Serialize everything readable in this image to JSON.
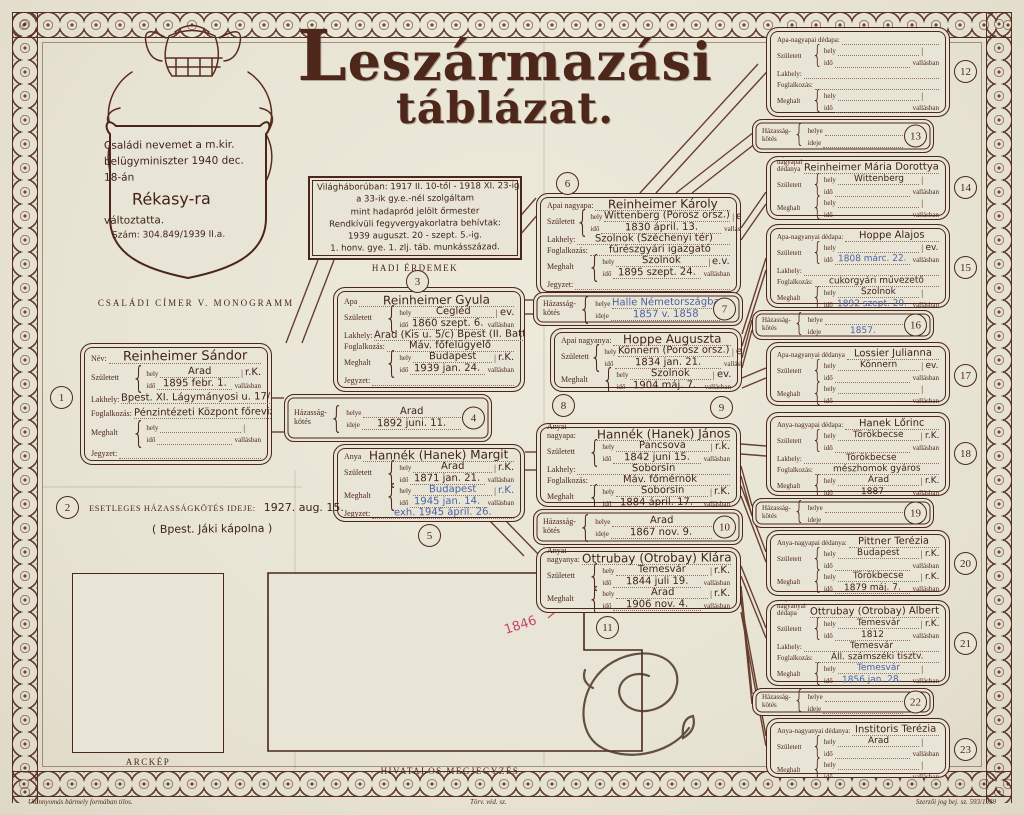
{
  "title": {
    "line1": "Leszármazási",
    "line2": "táblázat."
  },
  "fl": {
    "szuletett": "Született",
    "meghalt": "Meghalt",
    "hely": "hely",
    "ido": "idő",
    "vallasban": "vallásban",
    "lakhely": "Lakhely:",
    "foglalkozas": "Foglalkozás:",
    "jegyzet": "Jegyzet:",
    "hazassag": "Házasság-",
    "kotes": "kötés",
    "helye": "helye",
    "ideje": "ideje",
    "brace": "{",
    "bar": "|"
  },
  "crest": {
    "line1": "Családi nevemet a m.kir.",
    "line2": "belügyminiszter 1940 dec.",
    "line3": "18-án",
    "name": "Rékasy-ra",
    "line5": "változtatta.",
    "num": "Szám: 304.849/1939 II.a.",
    "caption": "CSALÁDI CÍMER V. MONOGRAMM"
  },
  "war": {
    "number": "3",
    "caption": "HADI ÉRDEMEK",
    "lines": [
      "Világháborúban: 1917 II. 10-től - 1918 XI. 23-ig",
      "a 33-ik gy.e.-nél szolgáltam",
      "mint hadapród jelölt őrmester",
      "Rendkívüli fegyvergyakorlatra behívtak:",
      "1939 auguszt. 20 - szept. 5.-ig.",
      "1. honv. gye. 1. zlj. táb. munkásszázad."
    ]
  },
  "esetleges": {
    "number": "2",
    "label": "ESETLEGES HÁZASSÁGKÖTÉS IDEJE:",
    "value": "1927. aug. 15.",
    "value2": "( Bpest. Jáki kápolna )"
  },
  "boxes": {
    "b1": {
      "number": "1",
      "name_label": "Név:",
      "name": "Reinheimer Sándor",
      "born_hely": "Arad",
      "born_rel": "r.K.",
      "born_ido": "1895 febr. 1.",
      "lakhely": "Bpest. XI. Lágymányosi u. 17/b.",
      "foglalkozas": "Pénzintézeti Központ főrevizor",
      "died_hely": "",
      "died_rel": "",
      "died_ido": "",
      "jegyzet": ""
    },
    "b3": {
      "name_label": "Apa",
      "name": "Reinheimer Gyula",
      "born_hely": "Cegléd",
      "born_rel": "ev.",
      "born_ido": "1860 szept. 6.",
      "lakhely": "Arad (Kis u. 5/c) Bpest (II. Batthyány u. 2)",
      "foglalkozas": "Máv. főfelügyelő",
      "died_hely": "Budapest",
      "died_rel": "r.K.",
      "died_ido": "1939 jan. 24.",
      "jegyzet": ""
    },
    "b5": {
      "number": "5",
      "name_label": "Anya",
      "name": "Hannék (Hanek) Margit",
      "born_hely": "Arad",
      "born_rel": "r.K.",
      "born_ido": "1871 jan. 21.",
      "died_hely": {
        "t": "Budapest",
        "ink": "blue"
      },
      "died_rel": {
        "t": "r.K.",
        "ink": "blue"
      },
      "died_ido": {
        "t": "1945 jan. 14.",
        "ink": "blue"
      },
      "jegyzet": {
        "t": "exh. 1945 ápril. 26.",
        "ink": "blue"
      }
    },
    "b6": {
      "number": "6",
      "name_label": "Apai nagyapa:",
      "name": "Reinheimer Károly",
      "born_hely": "Wittenberg (Porosz orsz.)",
      "born_rel": "ev.",
      "born_ido": "1830 ápril. 13.",
      "lakhely": "Szolnok (Széchenyi tér)",
      "foglalkozas": "fűrészgyári igazgató",
      "died_hely": "Szolnok",
      "died_rel": "e.v.",
      "died_ido": "1895 szept. 24.",
      "jegyzet": ""
    },
    "b8": {
      "number": "8",
      "name_label": "Apai nagyanya:",
      "name": "Hoppe Auguszta",
      "born_hely": "Könnern (Porosz orsz.)",
      "born_rel": "ev.",
      "born_ido": "1834 jan. 21.",
      "died_hely": "Szolnok",
      "died_rel": "ev.",
      "died_ido": "1904 máj. 7.",
      "jegyzet": ""
    },
    "b9": {
      "number": "9",
      "name_label": "Anyai nagyapa:",
      "name": "Hannék (Hanek) János",
      "born_hely": "Pancsova",
      "born_rel": "r.k.",
      "born_ido": "1842 juni 15.",
      "lakhely": "Soborsin",
      "foglalkozas": "Máv. főmérnök",
      "died_hely": "Soborsin",
      "died_rel": "r.K.",
      "died_ido": "1884 ápril. 17.",
      "jegyzet": ""
    },
    "b11": {
      "number": "11",
      "name_label": "Anyai nagyanya:",
      "name": "Ottrubay (Otrobay) Klára",
      "born_hely": "Temesvár",
      "born_rel": "r.K.",
      "born_ido": "1844 juli 19.",
      "died_hely": "Arad",
      "died_rel": "r.K.",
      "died_ido": "1906 nov. 4.",
      "jegyzet": ""
    },
    "b12": {
      "number": "12",
      "name_label": "Apa-nagyapai dédapa:",
      "name": "",
      "born_hely": "",
      "born_rel": "",
      "born_ido": "",
      "lakhely": "",
      "foglalkozas": "",
      "died_hely": "",
      "died_rel": "",
      "died_ido": "",
      "jegyzet": ""
    },
    "b14": {
      "number": "14",
      "name_label": "Apa-nagyapai dédanya",
      "name": "Reinheimer Mária Dorottya",
      "born_hely": "Wittenberg",
      "born_rel": "",
      "born_ido": "",
      "died_hely": "",
      "died_rel": "",
      "died_ido": "",
      "jegyzet": ""
    },
    "b15": {
      "number": "15",
      "name_label": "Apa-nagyanyai dédapa:",
      "name": "Hoppe Alajos",
      "born_hely": "",
      "born_rel": "ev.",
      "born_ido": {
        "t": "1808 márc. 22.",
        "ink": "blue"
      },
      "lakhely": "",
      "foglalkozas": "cukorgyári művezető",
      "died_hely": "Szolnok",
      "died_rel": "",
      "died_ido": {
        "t": "1892 szept. 20.",
        "ink": "blue"
      },
      "jegyzet": ""
    },
    "b17": {
      "number": "17",
      "name_label": "Apa-nagyanyai dédanya",
      "name": "Lossier Julianna",
      "born_hely": "Könnern",
      "born_rel": "ev.",
      "born_ido": "",
      "died_hely": "",
      "died_rel": "",
      "died_ido": "",
      "jegyzet": ""
    },
    "b18": {
      "number": "18",
      "name_label": "Anya-nagyapai dédapa:",
      "name": "Hanek Lőrinc",
      "born_hely": "Törökbecse",
      "born_rel": "r.K.",
      "born_ido": "",
      "lakhely": "Törökbecse",
      "foglalkozas": "mészhomok gyáros",
      "died_hely": "Arad",
      "died_rel": "r.K.",
      "died_ido": "1887",
      "jegyzet": ""
    },
    "b20": {
      "number": "20",
      "name_label": "Anya-nagyapai dédanya:",
      "name": "Pittner Terézia",
      "born_hely": "Budapest",
      "born_rel": "r.K.",
      "born_ido": "",
      "died_hely": "Törökbecse",
      "died_rel": "r.K.",
      "died_ido": "1879 máj. 7.",
      "jegyzet": ""
    },
    "b21": {
      "number": "21",
      "name_label": "Anya-nagyanyai dédapa",
      "name": "Ottrubay (Otrobay) Albert",
      "born_hely": "Temesvár",
      "born_rel": "r.K.",
      "born_ido": "1812",
      "lakhely": "Temesvár",
      "foglalkozas": "Áll. számszéki tisztv.",
      "died_hely": {
        "t": "Temesvár",
        "ink": "blue"
      },
      "died_rel": "",
      "died_ido": {
        "t": "1856 jan. 28.",
        "ink": "blue"
      },
      "jegyzet": ""
    },
    "b23": {
      "number": "23",
      "name_label": "Anya-nagyanyai dédanya:",
      "name": "Institoris Terézia",
      "born_hely": "Arad",
      "born_rel": "",
      "born_ido": "",
      "died_hely": "",
      "died_rel": "",
      "died_ido": "",
      "jegyzet": ""
    }
  },
  "marriages": {
    "m4": {
      "number": "4",
      "helye": "Arad",
      "ideje": "1892 juni. 11."
    },
    "m7": {
      "number": "7",
      "helye": {
        "t": "Halle Németországba",
        "ink": "blue"
      },
      "ideje": {
        "t": "1857 v. 1858",
        "ink": "blue"
      }
    },
    "m10": {
      "number": "10",
      "helye": "Arad",
      "ideje": "1867 nov. 9."
    },
    "m13": {
      "number": "13",
      "helye": "",
      "ideje": ""
    },
    "m16": {
      "number": "16",
      "helye": "",
      "ideje": {
        "t": "1857.",
        "ink": "blue"
      }
    },
    "m19": {
      "number": "19",
      "helye": "",
      "ideje": ""
    },
    "m22": {
      "number": "22",
      "helye": "",
      "ideje": ""
    }
  },
  "annotations": {
    "red_year": "1846"
  },
  "footer": {
    "arckep": "ARCKÉP",
    "hivatalos": "HIVATALOS MEGJEGYZÉS",
    "left": "Utánnyomás bármely formában tilos.",
    "center": "Törv. véd. sz.",
    "right": "Szerzői jog bej. sz. 593/1939"
  },
  "colors": {
    "ink": "#4c261b",
    "blue_ink": "#4c63a2",
    "red_ink": "#c2486e",
    "paper": "#e9e5d6"
  }
}
